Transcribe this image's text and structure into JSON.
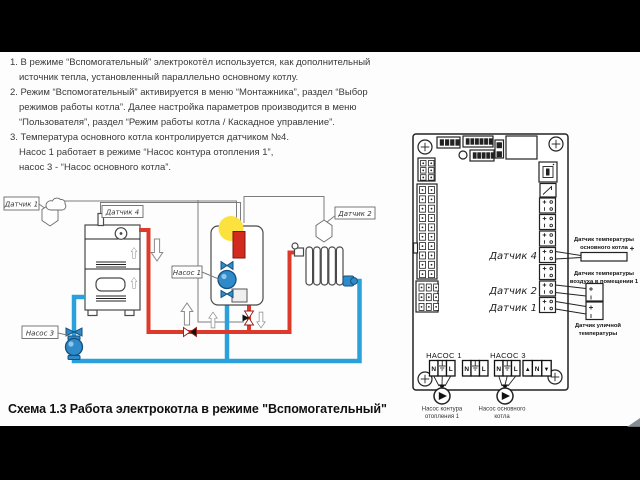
{
  "notes": {
    "l1": "1. В режиме “Вспомогательный” электрокотёл используется, как дополнительный",
    "l2": "источник тепла, установленный параллельно основному котлу.",
    "l3": "2. Режим “Вспомогательный” активируется в меню “Монтажника”, раздел “Выбор",
    "l4": "режимов работы котла”. Далее настройка параметров производится в меню",
    "l5": "“Пользователя”, раздел “Режим работы котла / Каскадное управление”.",
    "l6": "3. Температура основного котла контролируется датчиком №4.",
    "l7": "Насос 1 работает в режиме “Насос контура отопления 1”,",
    "l8": "насос 3 - “Насос основного котла”."
  },
  "caption": "Схема 1.3 Работа  электрокотла в режиме \"Вспомогательный\"",
  "piping": {
    "sensor1": "Датчик 1",
    "sensor4": "Датчик 4",
    "sensor2": "Датчик 2",
    "pump1": "Насос 1",
    "pump3": "Насос 3"
  },
  "board": {
    "sensor4": "Датчик 4",
    "sensor2": "Датчик 2",
    "sensor1": "Датчик 1",
    "pump1_header": "НАСОС 1",
    "pump3_header": "НАСОС 3",
    "terminal_labels": {
      "n": "N",
      "l": "L",
      "up": "▲",
      "down": "▼"
    },
    "ext_boiler_1": "Датчик температуры",
    "ext_boiler_2": "основного котла",
    "ext_room_1": "Датчик температуры",
    "ext_room_2": "воздуха в помещении 1",
    "ext_out_1": "Датчик уличной",
    "ext_out_2": "температуры",
    "pump1_cap_1": "Насос контура",
    "pump1_cap_2": "отопления 1",
    "pump3_cap_1": "Насос основного",
    "pump3_cap_2": "котла"
  },
  "colors": {
    "hot_pipe": "#dd3a2b",
    "cold_pipe": "#2ba1dc",
    "indicator": "#fce23e"
  }
}
